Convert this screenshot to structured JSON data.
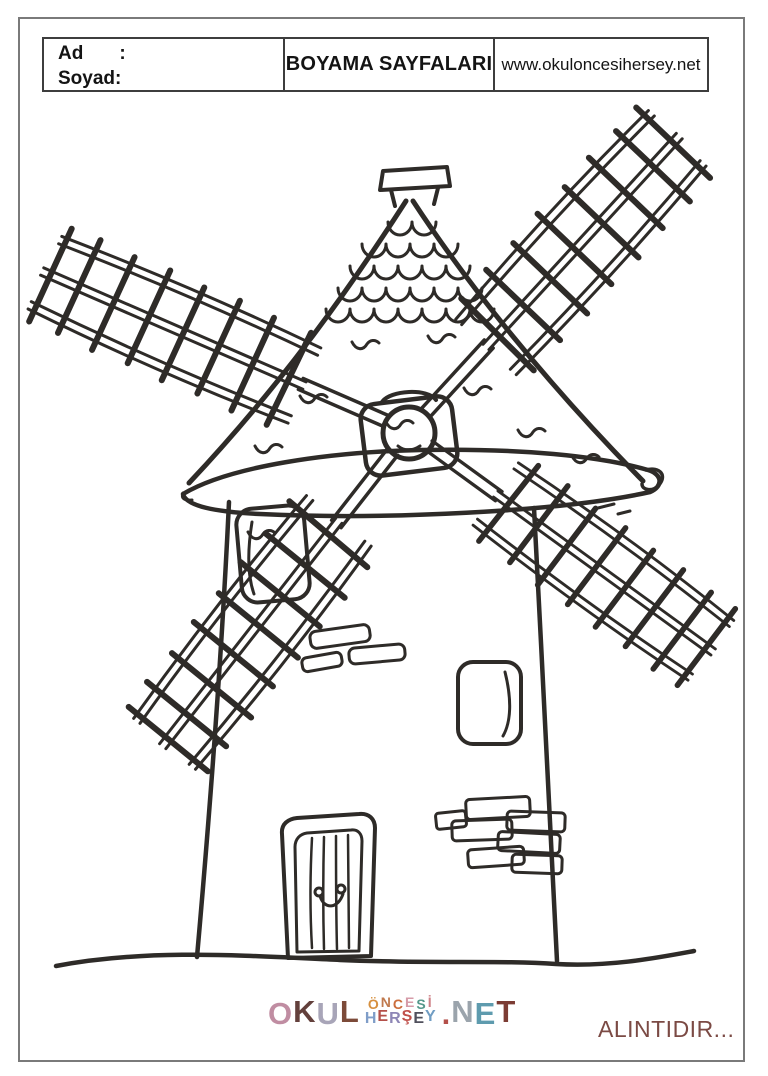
{
  "colors": {
    "ink": "#2e2b28",
    "page_border": "#7a7a7a",
    "header_border": "#3d3d3d",
    "attribution": "#7b4a44"
  },
  "header": {
    "name_label": "Ad",
    "name_colon": ":",
    "surname_label": "Soyad:",
    "title": "BOYAMA SAYFALARI",
    "website": "www.okuloncesihersey.net"
  },
  "artwork": {
    "subject": "windmill line drawing for coloring"
  },
  "footer": {
    "attribution": "ALINTIDIR...",
    "logo": {
      "okul": [
        {
          "ch": "O",
          "color": "#c08da2"
        },
        {
          "ch": "K",
          "color": "#63403c"
        },
        {
          "ch": "U",
          "color": "#a8a5b8"
        },
        {
          "ch": "L",
          "color": "#7c4a39"
        }
      ],
      "oncesi": [
        {
          "ch": "Ö",
          "color": "#d6903f"
        },
        {
          "ch": "N",
          "color": "#c07a4e"
        },
        {
          "ch": "C",
          "color": "#cb6d3c"
        },
        {
          "ch": "E",
          "color": "#d69ba8"
        },
        {
          "ch": "S",
          "color": "#55988b"
        },
        {
          "ch": "İ",
          "color": "#ce8187"
        }
      ],
      "hersey": [
        {
          "ch": "H",
          "color": "#7f9dc8"
        },
        {
          "ch": "E",
          "color": "#b4504a"
        },
        {
          "ch": "R",
          "color": "#8d86b6"
        },
        {
          "ch": "Ş",
          "color": "#c0504a"
        },
        {
          "ch": "E",
          "color": "#50505c"
        },
        {
          "ch": "Y",
          "color": "#709dc3"
        }
      ],
      "net": [
        {
          "ch": ".",
          "color": "#b4504a"
        },
        {
          "ch": "N",
          "color": "#9ba4ac"
        },
        {
          "ch": "E",
          "color": "#5e9bae"
        },
        {
          "ch": "T",
          "color": "#7c3c34"
        }
      ]
    }
  }
}
